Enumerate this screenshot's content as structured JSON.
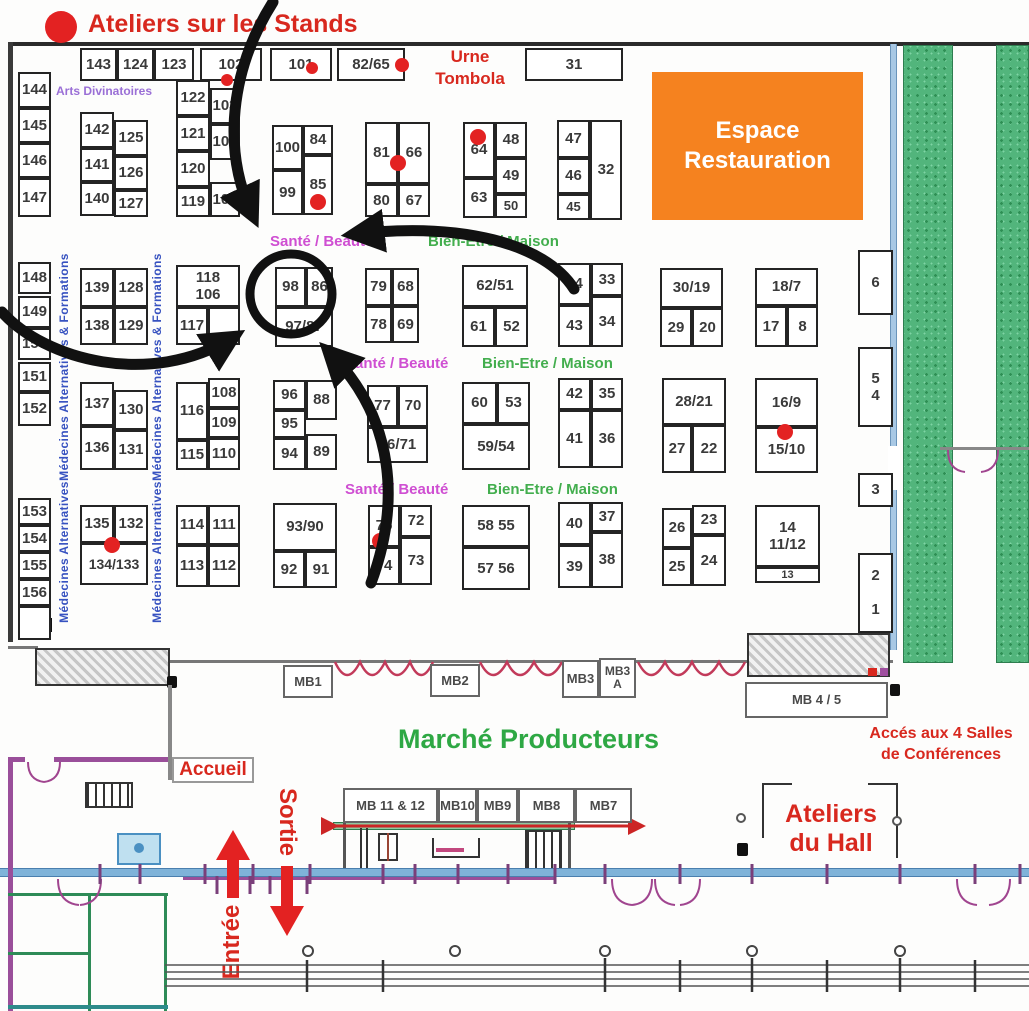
{
  "title": "Ateliers sur les Stands",
  "areas": {
    "espace_restauration": "Espace\nRestauration",
    "urne_tombola": "Urne\nTombola",
    "marche_producteurs": "Marché Producteurs",
    "acces_salles": "Accés aux 4 Salles\nde Conférences",
    "accueil": "Accueil",
    "ateliers_hall": "Ateliers\ndu Hall",
    "sortie": "Sortie",
    "entree": "Entrée"
  },
  "colors": {
    "red": "#d8281e",
    "orange": "#f5821f",
    "magenta": "#cf4fd2",
    "green": "#2ea844",
    "blue_text": "#3752c0",
    "purple_text": "#9a6fd6",
    "wall_blue": "#7fb3d9",
    "wall_purple": "#9a4f9a",
    "strip_green": "#52b57c"
  },
  "labels": [
    {
      "t": "Santé / Beauté",
      "cls": "sante",
      "x": 270,
      "y": 233
    },
    {
      "t": "Bien-Etre / Maison",
      "cls": "bien",
      "x": 428,
      "y": 233
    },
    {
      "t": "Santé / Beauté",
      "cls": "sante",
      "x": 345,
      "y": 355
    },
    {
      "t": "Bien-Etre / Maison",
      "cls": "bien",
      "x": 482,
      "y": 355
    },
    {
      "t": "Santé / Beauté",
      "cls": "sante",
      "x": 345,
      "y": 481
    },
    {
      "t": "Bien-Etre / Maison",
      "cls": "bien",
      "x": 487,
      "y": 481
    },
    {
      "t": "Arts Divinatoires",
      "cls": "arts",
      "x": 56,
      "y": 84
    },
    {
      "t": "Médecines Alternatives & Formations",
      "cls": "med",
      "rot": -90,
      "x": 64,
      "y": 367
    },
    {
      "t": "Médecines Alternatives & Formations",
      "cls": "med",
      "rot": -90,
      "x": 157,
      "y": 367
    },
    {
      "t": "Médecines Alternatives",
      "cls": "med",
      "rot": -90,
      "x": 64,
      "y": 552
    },
    {
      "t": "Médecines Alternatives",
      "cls": "med",
      "rot": -90,
      "x": 157,
      "y": 552
    }
  ],
  "booths": [
    {
      "t": "143",
      "x": 80,
      "y": 48,
      "w": 37,
      "h": 33
    },
    {
      "t": "124",
      "x": 117,
      "y": 48,
      "w": 37,
      "h": 33
    },
    {
      "t": "123",
      "x": 154,
      "y": 48,
      "w": 40,
      "h": 33
    },
    {
      "t": "102",
      "x": 200,
      "y": 48,
      "w": 62,
      "h": 33
    },
    {
      "t": "101",
      "x": 270,
      "y": 48,
      "w": 62,
      "h": 33
    },
    {
      "t": "82/65",
      "x": 337,
      "y": 48,
      "w": 68,
      "h": 33
    },
    {
      "t": "31",
      "x": 525,
      "y": 48,
      "w": 98,
      "h": 33
    },
    {
      "t": "144",
      "x": 18,
      "y": 72,
      "w": 33,
      "h": 36
    },
    {
      "t": "145",
      "x": 18,
      "y": 108,
      "w": 33,
      "h": 35
    },
    {
      "t": "146",
      "x": 18,
      "y": 143,
      "w": 33,
      "h": 35
    },
    {
      "t": "147",
      "x": 18,
      "y": 178,
      "w": 33,
      "h": 39
    },
    {
      "t": "142",
      "x": 80,
      "y": 112,
      "w": 34,
      "h": 36
    },
    {
      "t": "141",
      "x": 80,
      "y": 148,
      "w": 34,
      "h": 34
    },
    {
      "t": "140",
      "x": 80,
      "y": 182,
      "w": 34,
      "h": 34
    },
    {
      "t": "125",
      "x": 114,
      "y": 120,
      "w": 34,
      "h": 36
    },
    {
      "t": "126",
      "x": 114,
      "y": 156,
      "w": 34,
      "h": 34
    },
    {
      "t": "127",
      "x": 114,
      "y": 190,
      "w": 34,
      "h": 27
    },
    {
      "t": "122",
      "x": 176,
      "y": 80,
      "w": 34,
      "h": 36
    },
    {
      "t": "121",
      "x": 176,
      "y": 116,
      "w": 34,
      "h": 35
    },
    {
      "t": "120",
      "x": 176,
      "y": 151,
      "w": 34,
      "h": 36
    },
    {
      "t": "119",
      "x": 176,
      "y": 187,
      "w": 34,
      "h": 30
    },
    {
      "t": "103",
      "x": 210,
      "y": 88,
      "w": 30,
      "h": 36
    },
    {
      "t": "104",
      "x": 210,
      "y": 124,
      "w": 30,
      "h": 36
    },
    {
      "t": "105",
      "x": 210,
      "y": 182,
      "w": 30,
      "h": 35
    },
    {
      "t": "100",
      "x": 272,
      "y": 125,
      "w": 31,
      "h": 45
    },
    {
      "t": "99",
      "x": 272,
      "y": 170,
      "w": 31,
      "h": 45
    },
    {
      "t": "84",
      "x": 303,
      "y": 125,
      "w": 30,
      "h": 30
    },
    {
      "t": "85",
      "x": 303,
      "y": 155,
      "w": 30,
      "h": 60
    },
    {
      "t": "81",
      "x": 365,
      "y": 122,
      "w": 33,
      "h": 62
    },
    {
      "t": "66",
      "x": 398,
      "y": 122,
      "w": 32,
      "h": 62
    },
    {
      "t": "80",
      "x": 365,
      "y": 184,
      "w": 33,
      "h": 33
    },
    {
      "t": "67",
      "x": 398,
      "y": 184,
      "w": 32,
      "h": 33
    },
    {
      "t": "64",
      "x": 463,
      "y": 122,
      "w": 32,
      "h": 56
    },
    {
      "t": "63",
      "x": 463,
      "y": 178,
      "w": 32,
      "h": 40
    },
    {
      "t": "48",
      "x": 495,
      "y": 122,
      "w": 32,
      "h": 36
    },
    {
      "t": "49",
      "x": 495,
      "y": 158,
      "w": 32,
      "h": 36
    },
    {
      "t": "50",
      "x": 495,
      "y": 194,
      "w": 32,
      "h": 24,
      "fs": 13
    },
    {
      "t": "47",
      "x": 557,
      "y": 120,
      "w": 33,
      "h": 38
    },
    {
      "t": "46",
      "x": 557,
      "y": 158,
      "w": 33,
      "h": 36
    },
    {
      "t": "45",
      "x": 557,
      "y": 194,
      "w": 33,
      "h": 26,
      "fs": 13
    },
    {
      "t": "32",
      "x": 590,
      "y": 120,
      "w": 32,
      "h": 100
    },
    {
      "t": "148",
      "x": 18,
      "y": 262,
      "w": 33,
      "h": 32
    },
    {
      "t": "149",
      "x": 18,
      "y": 296,
      "w": 33,
      "h": 32
    },
    {
      "t": "150",
      "x": 18,
      "y": 328,
      "w": 33,
      "h": 32
    },
    {
      "t": "151",
      "x": 18,
      "y": 362,
      "w": 33,
      "h": 30
    },
    {
      "t": "152",
      "x": 18,
      "y": 392,
      "w": 33,
      "h": 34
    },
    {
      "t": "139",
      "x": 80,
      "y": 268,
      "w": 34,
      "h": 39
    },
    {
      "t": "128",
      "x": 114,
      "y": 268,
      "w": 34,
      "h": 39
    },
    {
      "t": "138",
      "x": 80,
      "y": 307,
      "w": 34,
      "h": 38
    },
    {
      "t": "129",
      "x": 114,
      "y": 307,
      "w": 34,
      "h": 38
    },
    {
      "t": "118\n106",
      "x": 176,
      "y": 265,
      "w": 64,
      "h": 42
    },
    {
      "t": "117",
      "x": 176,
      "y": 307,
      "w": 32,
      "h": 38
    },
    {
      "t": "",
      "x": 208,
      "y": 307,
      "w": 32,
      "h": 38
    },
    {
      "t": "98",
      "x": 275,
      "y": 267,
      "w": 31,
      "h": 40
    },
    {
      "t": "86",
      "x": 306,
      "y": 267,
      "w": 27,
      "h": 40
    },
    {
      "t": "97/87",
      "x": 275,
      "y": 307,
      "w": 58,
      "h": 40
    },
    {
      "t": "79",
      "x": 365,
      "y": 268,
      "w": 27,
      "h": 38
    },
    {
      "t": "68",
      "x": 392,
      "y": 268,
      "w": 27,
      "h": 38
    },
    {
      "t": "78",
      "x": 365,
      "y": 306,
      "w": 27,
      "h": 37
    },
    {
      "t": "69",
      "x": 392,
      "y": 306,
      "w": 27,
      "h": 37
    },
    {
      "t": "62/51",
      "x": 462,
      "y": 265,
      "w": 66,
      "h": 42
    },
    {
      "t": "61",
      "x": 462,
      "y": 307,
      "w": 33,
      "h": 40
    },
    {
      "t": "52",
      "x": 495,
      "y": 307,
      "w": 33,
      "h": 40
    },
    {
      "t": "44",
      "x": 558,
      "y": 263,
      "w": 33,
      "h": 42
    },
    {
      "t": "33",
      "x": 591,
      "y": 263,
      "w": 32,
      "h": 33
    },
    {
      "t": "34",
      "x": 591,
      "y": 296,
      "w": 32,
      "h": 51
    },
    {
      "t": "43",
      "x": 558,
      "y": 305,
      "w": 33,
      "h": 42
    },
    {
      "t": "30/19",
      "x": 660,
      "y": 268,
      "w": 63,
      "h": 40
    },
    {
      "t": "29",
      "x": 660,
      "y": 308,
      "w": 32,
      "h": 39
    },
    {
      "t": "20",
      "x": 692,
      "y": 308,
      "w": 31,
      "h": 39
    },
    {
      "t": "18/7",
      "x": 755,
      "y": 268,
      "w": 63,
      "h": 38
    },
    {
      "t": "17",
      "x": 755,
      "y": 306,
      "w": 32,
      "h": 41
    },
    {
      "t": "8",
      "x": 787,
      "y": 306,
      "w": 31,
      "h": 41
    },
    {
      "t": "6",
      "x": 858,
      "y": 250,
      "w": 35,
      "h": 65
    },
    {
      "t": "5\n4",
      "x": 858,
      "y": 347,
      "w": 35,
      "h": 80
    },
    {
      "t": "137",
      "x": 80,
      "y": 382,
      "w": 34,
      "h": 44
    },
    {
      "t": "136",
      "x": 80,
      "y": 426,
      "w": 34,
      "h": 44
    },
    {
      "t": "130",
      "x": 114,
      "y": 390,
      "w": 34,
      "h": 40
    },
    {
      "t": "131",
      "x": 114,
      "y": 430,
      "w": 34,
      "h": 40
    },
    {
      "t": "116",
      "x": 176,
      "y": 382,
      "w": 32,
      "h": 58
    },
    {
      "t": "115",
      "x": 176,
      "y": 440,
      "w": 32,
      "h": 30
    },
    {
      "t": "108",
      "x": 208,
      "y": 378,
      "w": 32,
      "h": 30
    },
    {
      "t": "109",
      "x": 208,
      "y": 408,
      "w": 32,
      "h": 30
    },
    {
      "t": "110",
      "x": 208,
      "y": 438,
      "w": 32,
      "h": 32
    },
    {
      "t": "96",
      "x": 273,
      "y": 380,
      "w": 33,
      "h": 30
    },
    {
      "t": "95",
      "x": 273,
      "y": 410,
      "w": 33,
      "h": 28
    },
    {
      "t": "94",
      "x": 273,
      "y": 438,
      "w": 33,
      "h": 32
    },
    {
      "t": "88",
      "x": 306,
      "y": 380,
      "w": 31,
      "h": 40
    },
    {
      "t": "89",
      "x": 306,
      "y": 434,
      "w": 31,
      "h": 36
    },
    {
      "t": "77",
      "x": 367,
      "y": 385,
      "w": 31,
      "h": 42
    },
    {
      "t": "70",
      "x": 398,
      "y": 385,
      "w": 30,
      "h": 42
    },
    {
      "t": "76/71",
      "x": 367,
      "y": 427,
      "w": 61,
      "h": 36
    },
    {
      "t": "60",
      "x": 462,
      "y": 382,
      "w": 35,
      "h": 42
    },
    {
      "t": "53",
      "x": 497,
      "y": 382,
      "w": 33,
      "h": 42
    },
    {
      "t": "59/54",
      "x": 462,
      "y": 424,
      "w": 68,
      "h": 46
    },
    {
      "t": "42",
      "x": 558,
      "y": 378,
      "w": 33,
      "h": 32
    },
    {
      "t": "35",
      "x": 591,
      "y": 378,
      "w": 32,
      "h": 32
    },
    {
      "t": "41",
      "x": 558,
      "y": 410,
      "w": 33,
      "h": 58
    },
    {
      "t": "36",
      "x": 591,
      "y": 410,
      "w": 32,
      "h": 58
    },
    {
      "t": "28/21",
      "x": 662,
      "y": 378,
      "w": 64,
      "h": 47
    },
    {
      "t": "27",
      "x": 662,
      "y": 425,
      "w": 30,
      "h": 48
    },
    {
      "t": "22",
      "x": 692,
      "y": 425,
      "w": 34,
      "h": 48
    },
    {
      "t": "16/9",
      "x": 755,
      "y": 378,
      "w": 63,
      "h": 49
    },
    {
      "t": "15/10",
      "x": 755,
      "y": 427,
      "w": 63,
      "h": 46
    },
    {
      "t": "3",
      "x": 858,
      "y": 473,
      "w": 35,
      "h": 34
    },
    {
      "t": "153",
      "x": 18,
      "y": 498,
      "w": 33,
      "h": 27
    },
    {
      "t": "154",
      "x": 18,
      "y": 525,
      "w": 33,
      "h": 27
    },
    {
      "t": "155",
      "x": 18,
      "y": 552,
      "w": 33,
      "h": 27
    },
    {
      "t": "156",
      "x": 18,
      "y": 579,
      "w": 33,
      "h": 27
    },
    {
      "t": "",
      "x": 18,
      "y": 606,
      "w": 33,
      "h": 34
    },
    {
      "t": "135",
      "x": 80,
      "y": 505,
      "w": 34,
      "h": 38
    },
    {
      "t": "132",
      "x": 114,
      "y": 505,
      "w": 34,
      "h": 38
    },
    {
      "t": "134/133",
      "x": 80,
      "y": 543,
      "w": 68,
      "h": 42,
      "fs": 14
    },
    {
      "t": "114",
      "x": 176,
      "y": 505,
      "w": 32,
      "h": 40
    },
    {
      "t": "111",
      "x": 208,
      "y": 505,
      "w": 32,
      "h": 40
    },
    {
      "t": "113",
      "x": 176,
      "y": 545,
      "w": 32,
      "h": 42
    },
    {
      "t": "112",
      "x": 208,
      "y": 545,
      "w": 32,
      "h": 42
    },
    {
      "t": "93/90",
      "x": 273,
      "y": 503,
      "w": 64,
      "h": 48
    },
    {
      "t": "92",
      "x": 273,
      "y": 551,
      "w": 32,
      "h": 37
    },
    {
      "t": "91",
      "x": 305,
      "y": 551,
      "w": 32,
      "h": 37
    },
    {
      "t": "75",
      "x": 368,
      "y": 505,
      "w": 32,
      "h": 42
    },
    {
      "t": "72",
      "x": 400,
      "y": 505,
      "w": 32,
      "h": 32
    },
    {
      "t": "74",
      "x": 368,
      "y": 547,
      "w": 32,
      "h": 38
    },
    {
      "t": "73",
      "x": 400,
      "y": 537,
      "w": 32,
      "h": 48
    },
    {
      "t": "58 55",
      "x": 462,
      "y": 505,
      "w": 68,
      "h": 42
    },
    {
      "t": "57 56",
      "x": 462,
      "y": 547,
      "w": 68,
      "h": 43
    },
    {
      "t": "40",
      "x": 558,
      "y": 502,
      "w": 33,
      "h": 43
    },
    {
      "t": "37",
      "x": 591,
      "y": 502,
      "w": 32,
      "h": 30
    },
    {
      "t": "39",
      "x": 558,
      "y": 545,
      "w": 33,
      "h": 43
    },
    {
      "t": "38",
      "x": 591,
      "y": 532,
      "w": 32,
      "h": 56
    },
    {
      "t": "26",
      "x": 662,
      "y": 508,
      "w": 30,
      "h": 40
    },
    {
      "t": "23",
      "x": 692,
      "y": 505,
      "w": 34,
      "h": 30
    },
    {
      "t": "25",
      "x": 662,
      "y": 548,
      "w": 30,
      "h": 38
    },
    {
      "t": "24",
      "x": 692,
      "y": 535,
      "w": 34,
      "h": 51
    },
    {
      "t": "14\n11/12",
      "x": 755,
      "y": 505,
      "w": 65,
      "h": 62
    },
    {
      "t": "13",
      "x": 755,
      "y": 567,
      "w": 65,
      "h": 16,
      "fs": 11
    },
    {
      "t": "2\n1",
      "x": 858,
      "y": 553,
      "w": 35,
      "h": 80,
      "sp": true
    }
  ],
  "mb_boxes": [
    {
      "t": "MB1",
      "x": 283,
      "y": 665,
      "w": 50,
      "h": 33
    },
    {
      "t": "MB2",
      "x": 430,
      "y": 664,
      "w": 50,
      "h": 33
    },
    {
      "t": "MB3",
      "x": 562,
      "y": 660,
      "w": 37,
      "h": 38
    },
    {
      "t": "MB3\nA",
      "x": 599,
      "y": 658,
      "w": 37,
      "h": 40,
      "fs": 12
    },
    {
      "t": "MB 4 / 5",
      "x": 745,
      "y": 682,
      "w": 143,
      "h": 36
    },
    {
      "t": "MB 11 & 12",
      "x": 343,
      "y": 788,
      "w": 95,
      "h": 35
    },
    {
      "t": "MB10",
      "x": 438,
      "y": 788,
      "w": 39,
      "h": 35
    },
    {
      "t": "MB9",
      "x": 477,
      "y": 788,
      "w": 41,
      "h": 35
    },
    {
      "t": "MB8",
      "x": 518,
      "y": 788,
      "w": 57,
      "h": 35
    },
    {
      "t": "MB7",
      "x": 575,
      "y": 788,
      "w": 57,
      "h": 35
    }
  ],
  "red_dots": [
    {
      "x": 61,
      "y": 27,
      "r": 16
    },
    {
      "x": 227,
      "y": 80,
      "r": 6
    },
    {
      "x": 312,
      "y": 68,
      "r": 6
    },
    {
      "x": 402,
      "y": 65,
      "r": 7
    },
    {
      "x": 398,
      "y": 163,
      "r": 8
    },
    {
      "x": 478,
      "y": 137,
      "r": 8
    },
    {
      "x": 318,
      "y": 202,
      "r": 8
    },
    {
      "x": 785,
      "y": 432,
      "r": 8
    },
    {
      "x": 112,
      "y": 545,
      "r": 8
    },
    {
      "x": 380,
      "y": 541,
      "r": 8
    }
  ]
}
